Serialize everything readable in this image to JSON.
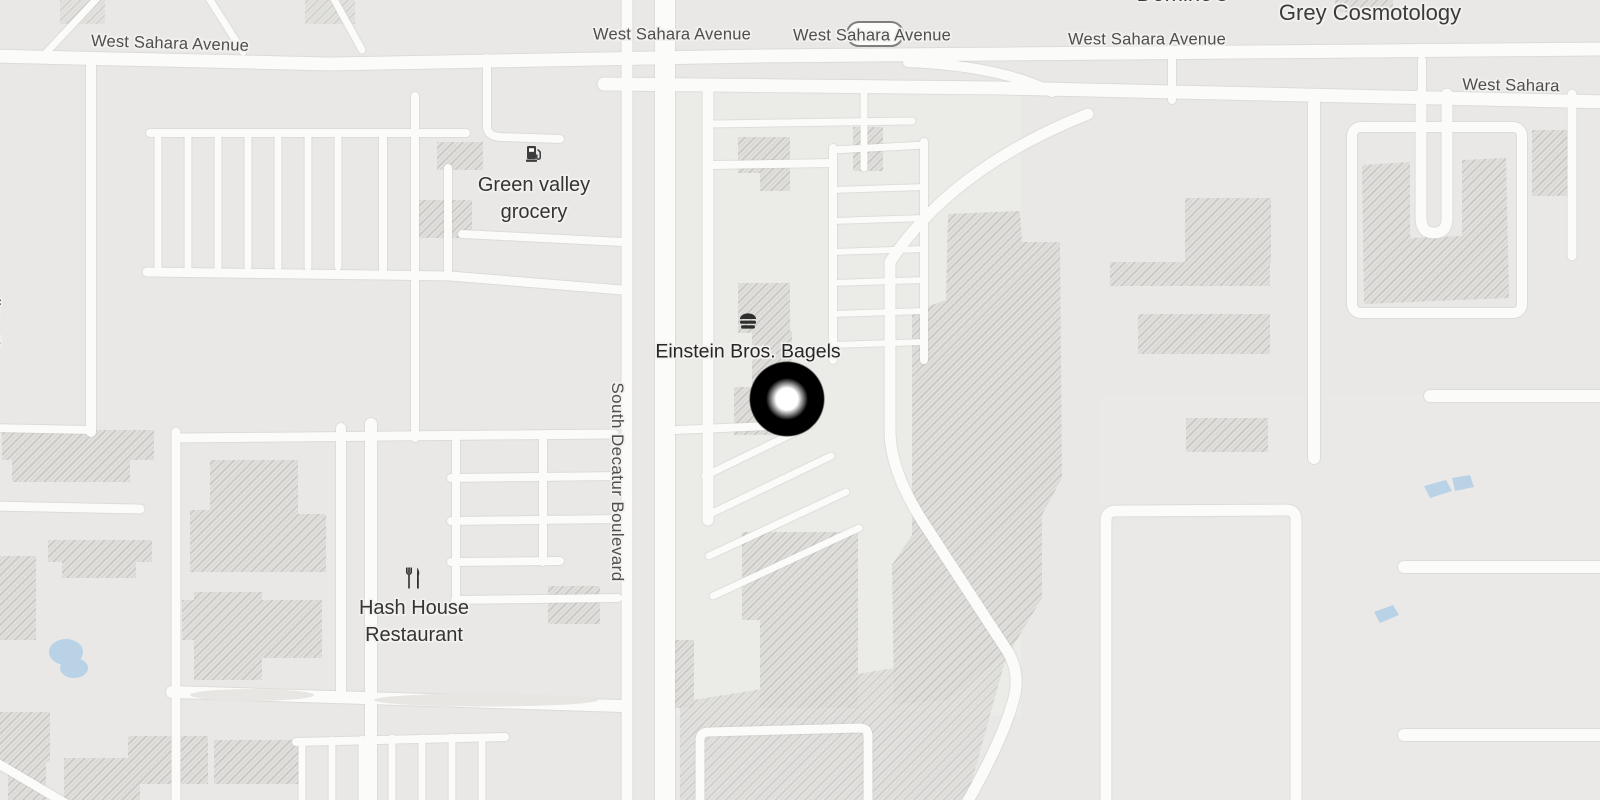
{
  "map": {
    "colors": {
      "background": "#e9e8e6",
      "road": "#fbfbf9",
      "building_hatch": "#cfceca",
      "water": "#b9d2e6",
      "street_label": "#4e4e4e",
      "poi_label": "#343434",
      "marker_outer": "#000000",
      "marker_center": "#ffffff"
    },
    "street_labels": {
      "sahara_left": "West Sahara Avenue",
      "sahara_center": "West Sahara Avenue",
      "sahara_shield": "West Sahara Avenue",
      "sahara_east": "West Sahara Avenue",
      "sahara_right_edge": "West Sahara",
      "decatur": "South Decatur Boulevard"
    },
    "poi_labels": {
      "dominos": "Domino's",
      "grey_cosmotology": "Grey Cosmotology",
      "green_valley_line1": "Green valley",
      "green_valley_line2": "grocery",
      "einstein": "Einstein Bros. Bagels",
      "hash_line1": "Hash House",
      "hash_line2": "Restaurant"
    },
    "edge_cut_labels": {
      "line1": "f",
      "line2": "s"
    },
    "icons": [
      "gas-station-icon",
      "bagel-icon",
      "restaurant-icon"
    ],
    "marker": {
      "name": "selected-location-marker",
      "x": 787,
      "y": 399
    }
  }
}
